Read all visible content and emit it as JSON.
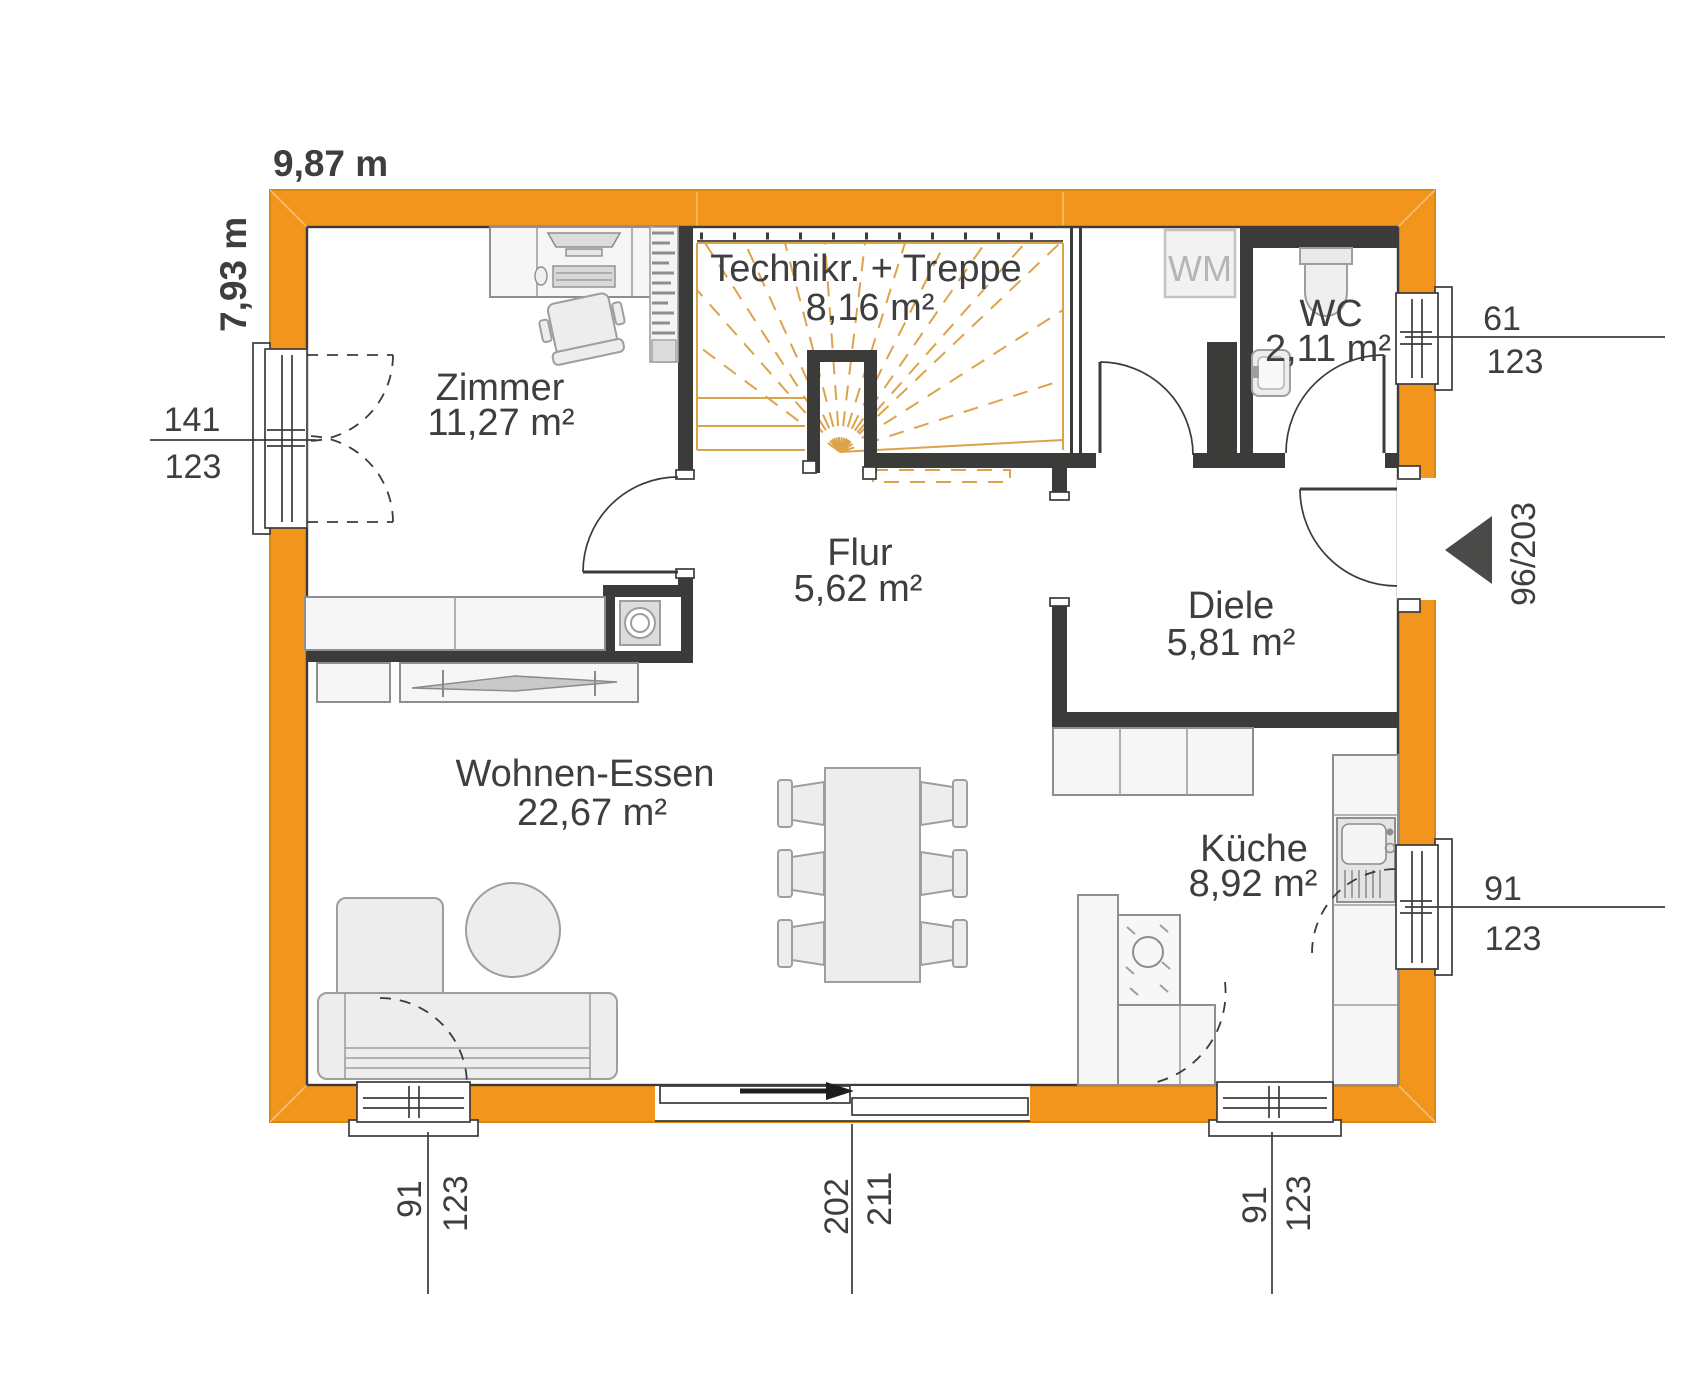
{
  "plan": {
    "width_label": "9,87 m",
    "height_label": "7,93 m"
  },
  "rooms": [
    {
      "name": "Zimmer",
      "area": "11,27 m²"
    },
    {
      "name": "Technikr. + Treppe",
      "area": "8,16 m²"
    },
    {
      "name": "WC",
      "area": "2,11 m²"
    },
    {
      "name": "Flur",
      "area": "5,62 m²"
    },
    {
      "name": "Diele",
      "area": "5,81 m²"
    },
    {
      "name": "Wohnen-Essen",
      "area": "22,67 m²"
    },
    {
      "name": "Küche",
      "area": "8,92 m²"
    }
  ],
  "appliances": {
    "washing_machine": "WM"
  },
  "openings": {
    "window_west": {
      "w": "141",
      "h": "123"
    },
    "window_north_east": {
      "w": "61",
      "h": "123"
    },
    "entrance_door": {
      "label": "96/203"
    },
    "window_east_kitchen": {
      "w": "91",
      "h": "123"
    },
    "window_south_left": {
      "w": "91",
      "h": "123"
    },
    "sliding_door_south": {
      "w": "202",
      "h": "211"
    },
    "window_south_right": {
      "w": "91",
      "h": "123"
    }
  },
  "colors": {
    "exterior_wall": "#F2951C",
    "interior_wall": "#3B3B3A",
    "stair_lines": "#DDA34A",
    "furniture_fill": "#EDEDED",
    "furniture_stroke": "#9E9E9E",
    "text": "#3E3E3E",
    "muted_text": "#B5B5B5"
  }
}
